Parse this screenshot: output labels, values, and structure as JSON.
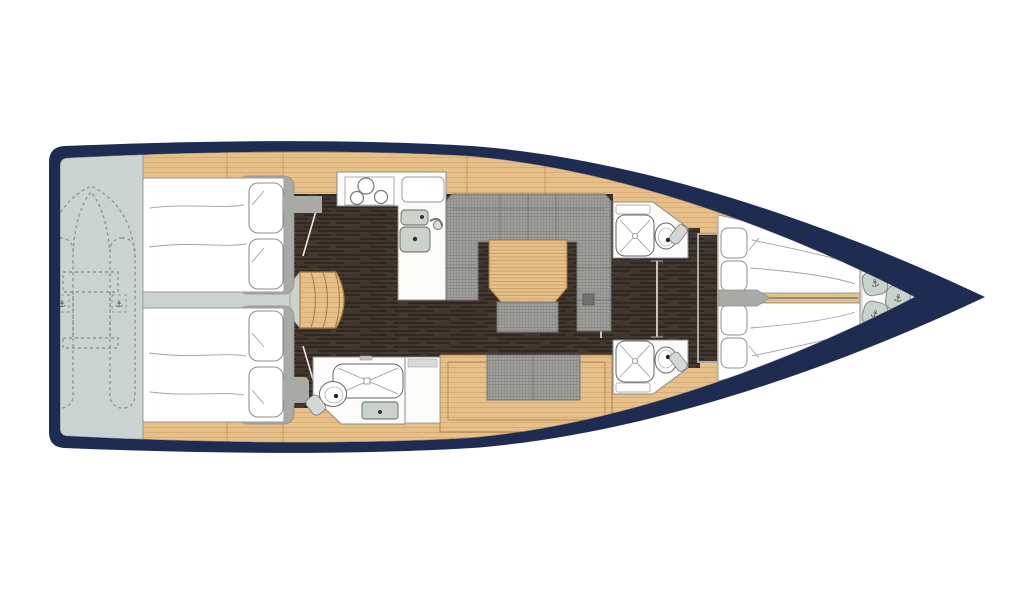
{
  "palette": {
    "page_bg": "#ffffff",
    "hull": "#1e2c52",
    "wood": "#e7c089",
    "wood_line": "#a9803f",
    "walnut": "#41372e",
    "platform": "#cbd3d0",
    "frame_gray": "#a9a9a5",
    "fabric": "#9e9e9a",
    "fixture_white": "#fbfbf9",
    "sink": "#c9d3cc",
    "outline": "#8c8c8a",
    "hatch": "#72726c",
    "dinghy_line": "#8d979c",
    "bedding_white": "#ffffff"
  },
  "icons": {
    "anchor": "⚓"
  }
}
